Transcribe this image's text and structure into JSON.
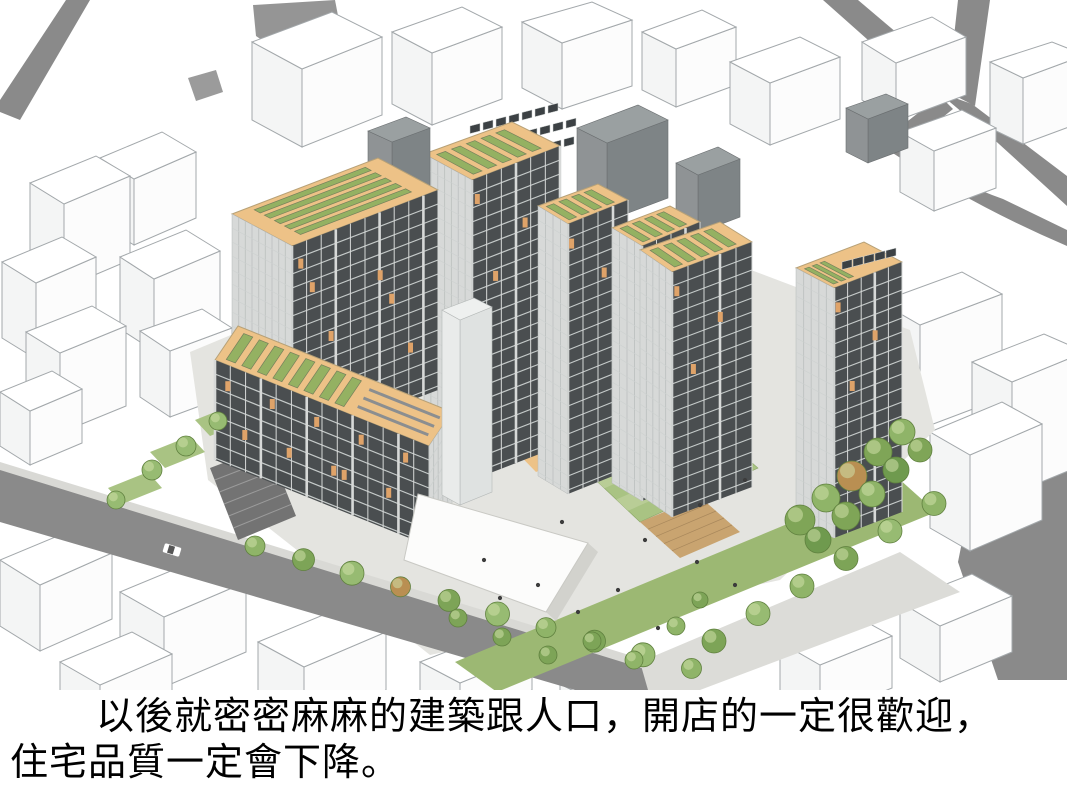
{
  "caption": {
    "line1": "以後就密密麻麻的建築跟人口，開店的一定很歡迎，",
    "line2": "住宅品質一定會下降。"
  },
  "palette": {
    "background": "#ffffff",
    "text": "#000000",
    "road": "#8a8a8a",
    "sidewalk": "#d9d9d5",
    "paving": "#e4e4e0",
    "wire_stroke": "#a3a8ab",
    "wire_face": "#f4f5f5",
    "facade_dark": "#4a4e50",
    "facade_light": "#d7d9d8",
    "floor_line": "#c5cac9",
    "accent_orange": "#dfa369",
    "roof_deck": "#edc287",
    "roof_green": "#94b162",
    "roof_green_edge": "#75805c",
    "lawn": "#a9c383",
    "lawn_stripe": "#bccf9a",
    "lawn_dark": "#9cb873",
    "tree_green": "#8fb468",
    "tree_dark_edge": "#60813f",
    "tree_autumn": "#b98f52",
    "mech_top": "#9aa0a1",
    "mech_side": "#7e8486",
    "solar": "#3c4144",
    "canopy": "#fcfcfb",
    "wood_deck": "#c9a470",
    "stair_dark": "#737373"
  }
}
